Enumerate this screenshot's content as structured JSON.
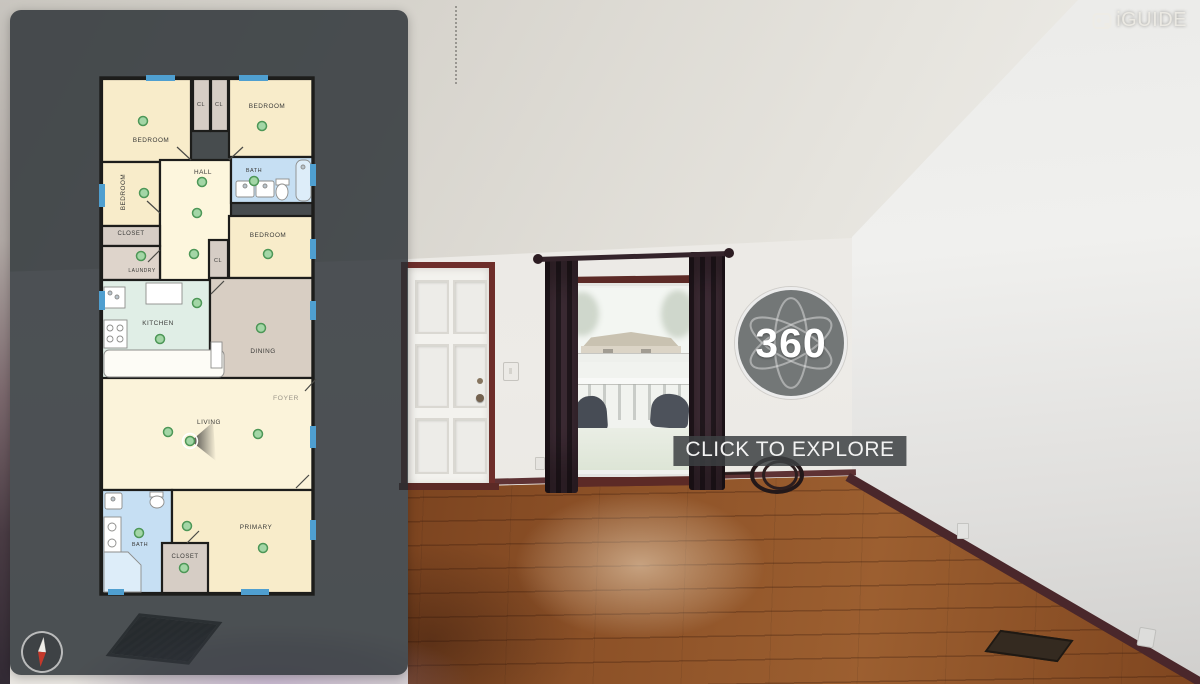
{
  "branding": {
    "logo_text": "iGUIDE"
  },
  "viewer": {
    "badge_label": "360",
    "cta_label": "CLICK TO EXPLORE"
  },
  "theme": {
    "panel_bg": "rgba(40,46,51,0.82)",
    "badge_bg": "rgba(98,102,104,0.88)",
    "cta_bg": "rgba(60,64,66,0.85)",
    "wood_dark": "#56290f",
    "wood_mid": "#6f3a1a",
    "wood_light": "#9c5f30",
    "curtain_dark": "#241a20",
    "curtain_light": "#43303a",
    "door_frame": "#6e2e2a",
    "baseboard": "#5e3234"
  },
  "floorplan": {
    "wall_line": "#1d1d1b",
    "window_mark": "#4f9fd0",
    "marker_fill": "#a3d6a6",
    "marker_stroke": "#4d9757",
    "label_color": "#3b3b39",
    "outline": {
      "x": 101,
      "y": 78,
      "w": 212,
      "h": 516
    },
    "rooms": [
      {
        "label": "BEDROOM",
        "x": 102,
        "y": 79,
        "w": 89,
        "h": 83,
        "fill": "#f8ecca",
        "lx": 151,
        "ly": 142
      },
      {
        "label": "CL",
        "x": 193,
        "y": 79,
        "w": 17,
        "h": 52,
        "fill": "#d6cdc5",
        "lx": 201,
        "ly": 106,
        "ls": 5.5
      },
      {
        "label": "CL",
        "x": 211,
        "y": 79,
        "w": 17,
        "h": 52,
        "fill": "#d6cdc5",
        "lx": 219,
        "ly": 106,
        "ls": 5.5
      },
      {
        "label": "BEDROOM",
        "x": 229,
        "y": 79,
        "w": 84,
        "h": 78,
        "fill": "#f8ecca",
        "lx": 267,
        "ly": 108
      },
      {
        "label": "BEDROOM",
        "x": 102,
        "y": 162,
        "w": 58,
        "h": 64,
        "fill": "#f8ecca",
        "lx": 125,
        "ly": 192,
        "vertical": true
      },
      {
        "label": "HALL",
        "x": 160,
        "y": 160,
        "w": 71,
        "h": 122,
        "fill": "#fdf6dd",
        "lx": 203,
        "ly": 174
      },
      {
        "label": "BATH",
        "x": 231,
        "y": 157,
        "w": 82,
        "h": 46,
        "fill": "#c6dff3",
        "lx": 254,
        "ly": 172,
        "ls": 5.5
      },
      {
        "label": "BEDROOM",
        "x": 229,
        "y": 216,
        "w": 84,
        "h": 62,
        "fill": "#f8ecca",
        "lx": 268,
        "ly": 237
      },
      {
        "label": "CLOSET",
        "x": 102,
        "y": 226,
        "w": 58,
        "h": 20,
        "fill": "#d6cdc5",
        "lx": 131,
        "ly": 235,
        "ls": 6
      },
      {
        "label": "LAUNDRY",
        "x": 102,
        "y": 246,
        "w": 58,
        "h": 34,
        "fill": "#ded4cb",
        "lx": 142,
        "ly": 272,
        "ls": 5
      },
      {
        "label": "CL",
        "x": 209,
        "y": 240,
        "w": 19,
        "h": 38,
        "fill": "#d6cdc5",
        "lx": 218,
        "ly": 262,
        "ls": 5.5
      },
      {
        "label": "KITCHEN",
        "x": 102,
        "y": 280,
        "w": 108,
        "h": 100,
        "fill": "#e0eee6",
        "lx": 158,
        "ly": 325,
        "ls": 6.4
      },
      {
        "label": "DINING",
        "x": 210,
        "y": 278,
        "w": 103,
        "h": 100,
        "fill": "#d8cec3",
        "lx": 263,
        "ly": 353
      },
      {
        "label": "LIVING",
        "x": 102,
        "y": 378,
        "w": 211,
        "h": 112,
        "fill": "#fbf3da",
        "lx": 209,
        "ly": 424
      },
      {
        "label": "BATH",
        "x": 102,
        "y": 490,
        "w": 70,
        "h": 103,
        "fill": "#c6dff3",
        "lx": 140,
        "ly": 546,
        "ls": 5.5
      },
      {
        "label": "PRIMARY",
        "x": 172,
        "y": 490,
        "w": 141,
        "h": 103,
        "fill": "#f8ecca",
        "lx": 256,
        "ly": 529
      },
      {
        "label": "CLOSET",
        "x": 162,
        "y": 543,
        "w": 46,
        "h": 50,
        "fill": "#d6cdc5",
        "lx": 185,
        "ly": 558,
        "ls": 6
      }
    ],
    "free_labels": [
      {
        "text": "FOYER",
        "x": 286,
        "y": 400,
        "size": 6.8,
        "color": "#9c968a"
      }
    ],
    "fixtures": [
      {
        "t": "rect",
        "x": 236,
        "y": 181,
        "w": 18,
        "h": 16,
        "rx": 2
      },
      {
        "t": "circle",
        "cx": 245,
        "cy": 186,
        "r": 2
      },
      {
        "t": "rect",
        "x": 256,
        "y": 181,
        "w": 18,
        "h": 16,
        "rx": 2
      },
      {
        "t": "circle",
        "cx": 265,
        "cy": 186,
        "r": 2
      },
      {
        "t": "rect",
        "x": 276,
        "y": 179,
        "w": 13,
        "h": 6
      },
      {
        "t": "ellipse",
        "cx": 282,
        "cy": 192,
        "rx": 6,
        "ry": 8
      },
      {
        "t": "rect",
        "x": 296,
        "y": 160,
        "w": 15,
        "h": 41,
        "rx": 6,
        "f": "#ddedf9"
      },
      {
        "t": "circle",
        "cx": 303,
        "cy": 167,
        "r": 2
      },
      {
        "t": "rect",
        "x": 146,
        "y": 283,
        "w": 36,
        "h": 21
      },
      {
        "t": "rect",
        "x": 104,
        "y": 287,
        "w": 21,
        "h": 21
      },
      {
        "t": "circle",
        "cx": 110,
        "cy": 293,
        "r": 2
      },
      {
        "t": "circle",
        "cx": 117,
        "cy": 297,
        "r": 2
      },
      {
        "t": "rect",
        "x": 104,
        "y": 320,
        "w": 23,
        "h": 28
      },
      {
        "t": "circle",
        "cx": 110,
        "cy": 328,
        "r": 3,
        "f": "none"
      },
      {
        "t": "circle",
        "cx": 120,
        "cy": 328,
        "r": 3,
        "f": "none"
      },
      {
        "t": "circle",
        "cx": 110,
        "cy": 339,
        "r": 3,
        "f": "none"
      },
      {
        "t": "circle",
        "cx": 120,
        "cy": 339,
        "r": 3,
        "f": "none"
      },
      {
        "t": "rect",
        "x": 104,
        "y": 350,
        "w": 120,
        "h": 27,
        "rx": 5,
        "f": "#fdfcf6"
      },
      {
        "t": "rect",
        "x": 211,
        "y": 342,
        "w": 11,
        "h": 26
      },
      {
        "t": "rect",
        "x": 105,
        "y": 493,
        "w": 17,
        "h": 16,
        "rx": 2
      },
      {
        "t": "circle",
        "cx": 113,
        "cy": 499,
        "r": 2
      },
      {
        "t": "rect",
        "x": 150,
        "y": 492,
        "w": 13,
        "h": 5
      },
      {
        "t": "ellipse",
        "cx": 157,
        "cy": 502,
        "rx": 7,
        "ry": 6
      },
      {
        "t": "rect",
        "x": 104,
        "y": 517,
        "w": 17,
        "h": 36
      },
      {
        "t": "circle",
        "cx": 112,
        "cy": 527,
        "r": 4,
        "f": "none"
      },
      {
        "t": "circle",
        "cx": 112,
        "cy": 543,
        "r": 4,
        "f": "none"
      },
      {
        "t": "poly",
        "pts": "104,552 128,552 141,565 141,592 104,592",
        "f": "#ddedf9"
      }
    ],
    "doors": [
      [
        191,
        160,
        177,
        147
      ],
      [
        229,
        160,
        243,
        147
      ],
      [
        160,
        213,
        147,
        201
      ],
      [
        224,
        281,
        211,
        294
      ],
      [
        296,
        488,
        309,
        475
      ],
      [
        187,
        543,
        199,
        531
      ],
      [
        305,
        391,
        316,
        379
      ],
      [
        160,
        250,
        148,
        262
      ]
    ],
    "windows": [
      [
        146,
        75,
        29,
        6
      ],
      [
        239,
        75,
        29,
        6
      ],
      [
        99,
        184,
        6,
        23
      ],
      [
        99,
        291,
        6,
        19
      ],
      [
        310,
        164,
        6,
        22
      ],
      [
        310,
        239,
        6,
        20
      ],
      [
        310,
        301,
        6,
        19
      ],
      [
        310,
        426,
        6,
        22
      ],
      [
        310,
        520,
        6,
        20
      ],
      [
        241,
        589,
        28,
        6
      ],
      [
        108,
        589,
        16,
        6
      ]
    ],
    "cone": {
      "pts": "191,441 213,422 216,461"
    },
    "markers": [
      {
        "x": 143,
        "y": 121
      },
      {
        "x": 262,
        "y": 126
      },
      {
        "x": 144,
        "y": 193
      },
      {
        "x": 202,
        "y": 182
      },
      {
        "x": 254,
        "y": 181
      },
      {
        "x": 197,
        "y": 213
      },
      {
        "x": 141,
        "y": 256
      },
      {
        "x": 194,
        "y": 254
      },
      {
        "x": 268,
        "y": 254
      },
      {
        "x": 197,
        "y": 303
      },
      {
        "x": 160,
        "y": 339
      },
      {
        "x": 261,
        "y": 328
      },
      {
        "x": 168,
        "y": 432
      },
      {
        "x": 258,
        "y": 434
      },
      {
        "x": 190,
        "y": 441,
        "ring": true
      },
      {
        "x": 139,
        "y": 533
      },
      {
        "x": 187,
        "y": 526
      },
      {
        "x": 263,
        "y": 548
      },
      {
        "x": 184,
        "y": 568
      }
    ]
  }
}
